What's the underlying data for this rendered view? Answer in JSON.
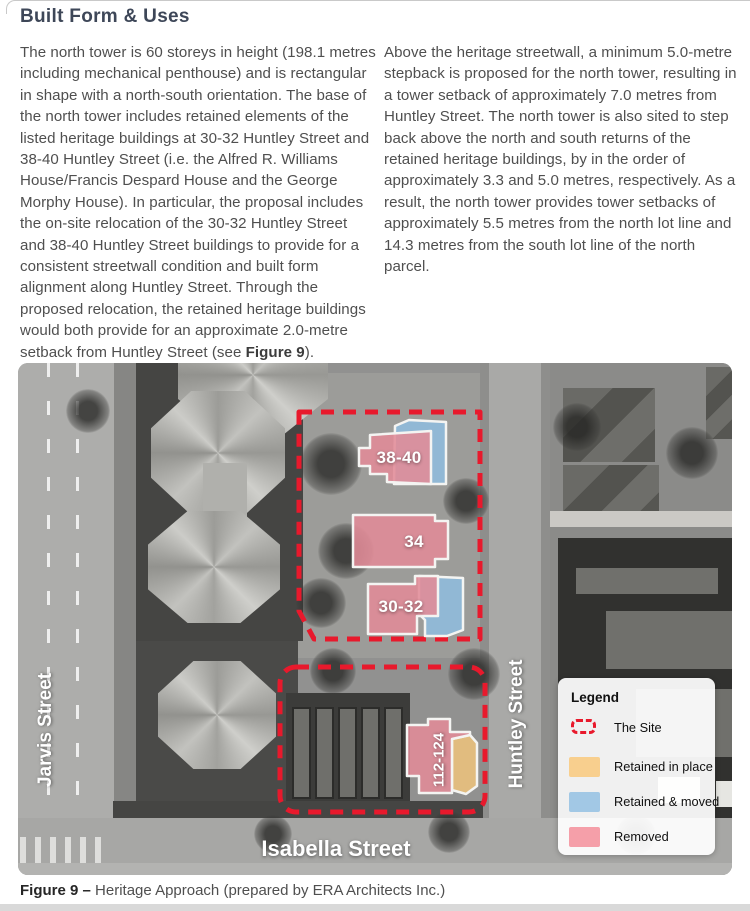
{
  "header": {
    "title": "Built Form & Uses"
  },
  "article": {
    "left_paragraph": "The north tower is 60 storeys in height (198.1 metres including mechanical penthouse) and is rectangular in shape with a north-south orientation. The base of the north tower includes retained elements of the listed heritage buildings at 30-32 Huntley Street and 38-40 Huntley Street (i.e. the Alfred R. Williams House/Francis Despard House and the George Morphy House). In particular, the proposal includes the on-site relocation of the 30-32 Huntley Street and 38-40 Huntley Street buildings to provide for a consistent streetwall condition and built form alignment along Huntley Street. Through the proposed relocation, the retained heritage buildings would both provide for an approximate 2.0-metre setback from Huntley Street (see ",
    "left_figure_ref": "Figure 9",
    "left_paragraph_end": ").",
    "right_paragraph": "Above the heritage streetwall, a minimum 5.0-metre stepback is proposed for the north tower, resulting in a tower setback of approximately 7.0 metres from Huntley Street. The north tower is also sited to step back above the north and south returns of the retained heritage buildings, by in the order of approximately 3.3 and 5.0 metres, respectively. As a result, the north tower provides tower setbacks of approximately 5.5 metres from the north lot line and 14.3 metres from the south lot line of the north parcel."
  },
  "map": {
    "streets": {
      "jarvis": "Jarvis Street",
      "huntley": "Huntley Street",
      "isabella": "Isabella Street"
    },
    "buildings": [
      {
        "label": "38-40",
        "status": "removed"
      },
      {
        "label": "34",
        "status": "removed"
      },
      {
        "label": "30-32",
        "status": "removed"
      },
      {
        "label": "112-124",
        "status": "removed"
      }
    ],
    "colors": {
      "site_outline": "#e8192c",
      "removed": "#e18b97",
      "retained_moved": "#8fbcdd",
      "retained_in_place": "#eac17d"
    },
    "legend": {
      "title": "Legend",
      "items": [
        {
          "label": "The Site",
          "type": "site-outline"
        },
        {
          "label": "Retained in place",
          "color": "#f8cf8e"
        },
        {
          "label": "Retained & moved",
          "color": "#a2c8e5"
        },
        {
          "label": "Removed",
          "color": "#f59fa9"
        }
      ]
    }
  },
  "caption": {
    "figure_label": "Figure 9 – ",
    "text": "Heritage Approach (prepared by ERA Architects Inc.)"
  }
}
